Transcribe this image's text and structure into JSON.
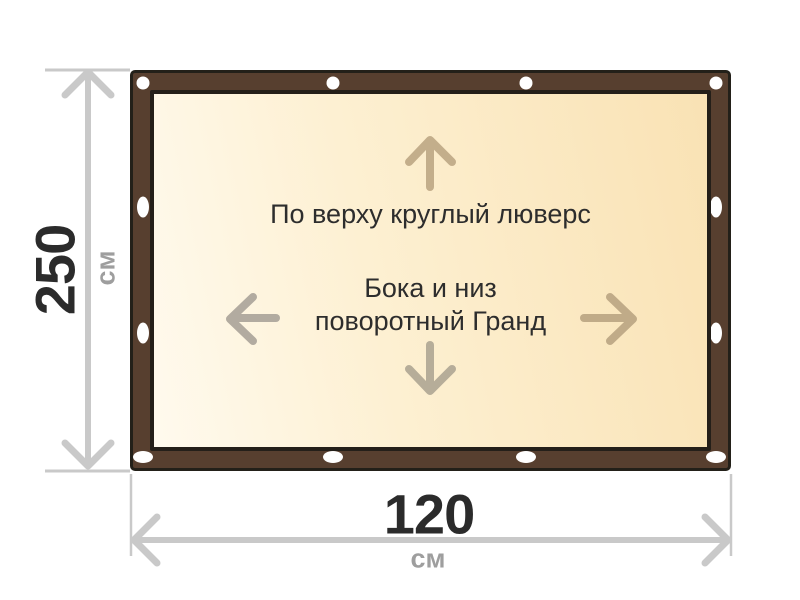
{
  "diagram": {
    "type": "banner-with-grommet-frame",
    "notes": {
      "top_edge": "По верху круглый люверс",
      "center_line1": "Бока и низ",
      "center_line2": "поворотный Гранд"
    },
    "height_dim": {
      "value": "250",
      "unit": "см"
    },
    "width_dim": {
      "value": "120",
      "unit": "см"
    },
    "grommet_count": 12
  },
  "colors": {
    "frame_brown": "#573f2f",
    "frame_outline": "#232019",
    "canvas_gradient_light": "#fffaee",
    "canvas_gradient_gold": "#f9e2b4",
    "grommet_white": "#ffffff",
    "arrow_up": "#c3ae8b",
    "arrow_left": "#b2aba0",
    "arrow_right": "#c0ab88",
    "arrow_down": "#b6ad99",
    "dimension_gray": "#c9c9c9",
    "dimension_value_dark": "#2b2b2b",
    "dimension_unit_gray": "#9e9e9e",
    "note_text": "#2d2d2d",
    "page_background": "#ffffff"
  }
}
